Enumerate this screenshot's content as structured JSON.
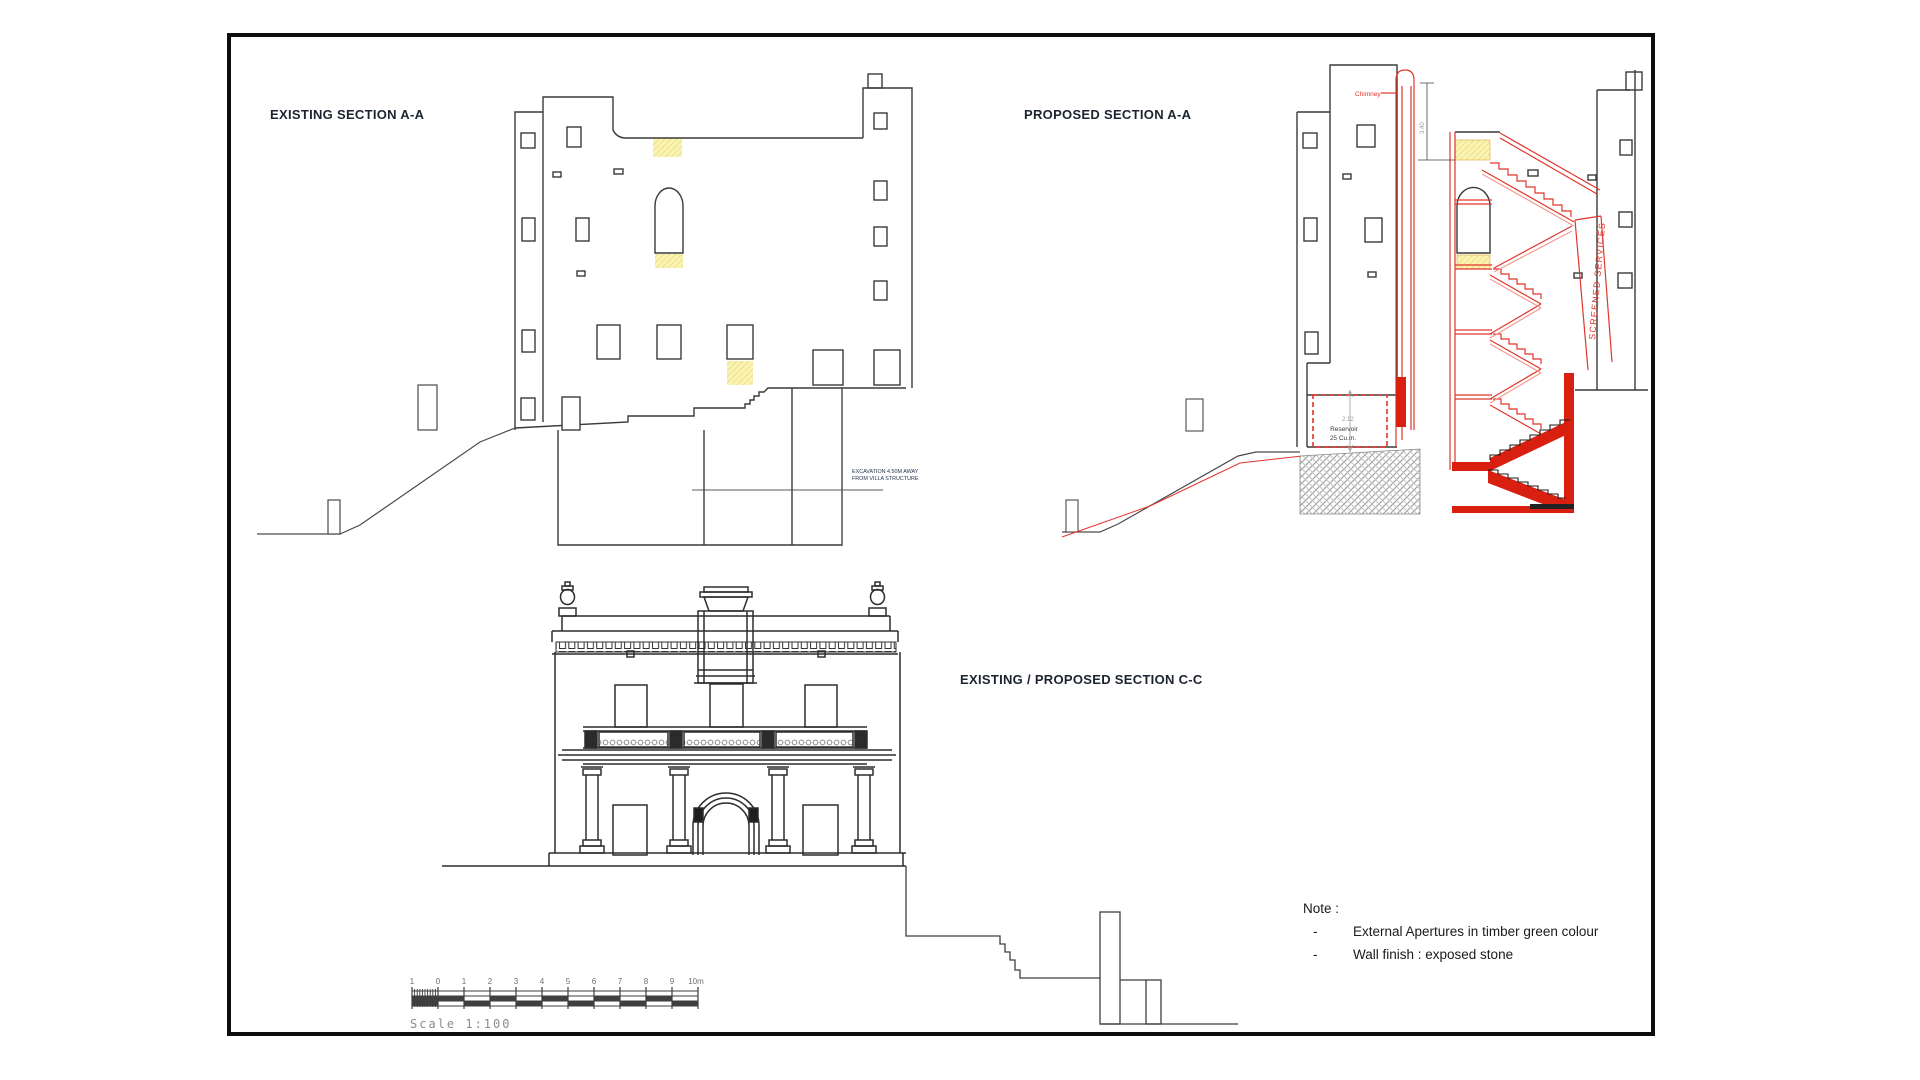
{
  "colors": {
    "line": "#333333",
    "accent_red": "#e0352b",
    "red_fill": "#d81f10",
    "highlight_yellow": "#faf4ae",
    "title_text": "#1c2430",
    "dim_gray": "#9a9a9a"
  },
  "titles": {
    "existing": "EXISTING SECTION A-A",
    "proposed": "PROPOSED SECTION A-A",
    "section_cc": "EXISTING / PROPOSED SECTION C-C"
  },
  "existing": {
    "excavation_note_line1": "EXCAVATION 4.50M AWAY",
    "excavation_note_line2": "FROM VILLA STRUCTURE"
  },
  "proposed": {
    "chimney_label": "Chimney",
    "stair_height_dim": "3.40",
    "reservoir_dim": "2.12",
    "reservoir_label_line1": "Reservoir",
    "reservoir_label_line2": "25 Cu.m.",
    "screened_services_label": "SCREENED  SERVICES"
  },
  "note": {
    "heading": "Note :",
    "bullet": "-",
    "items": [
      "External Apertures in timber green colour",
      "Wall finish : exposed stone"
    ]
  },
  "scalebar": {
    "caption": "Scale 1:100",
    "labels": [
      "1",
      "0",
      "1",
      "2",
      "3",
      "4",
      "5",
      "6",
      "7",
      "8",
      "9",
      "10m"
    ]
  }
}
